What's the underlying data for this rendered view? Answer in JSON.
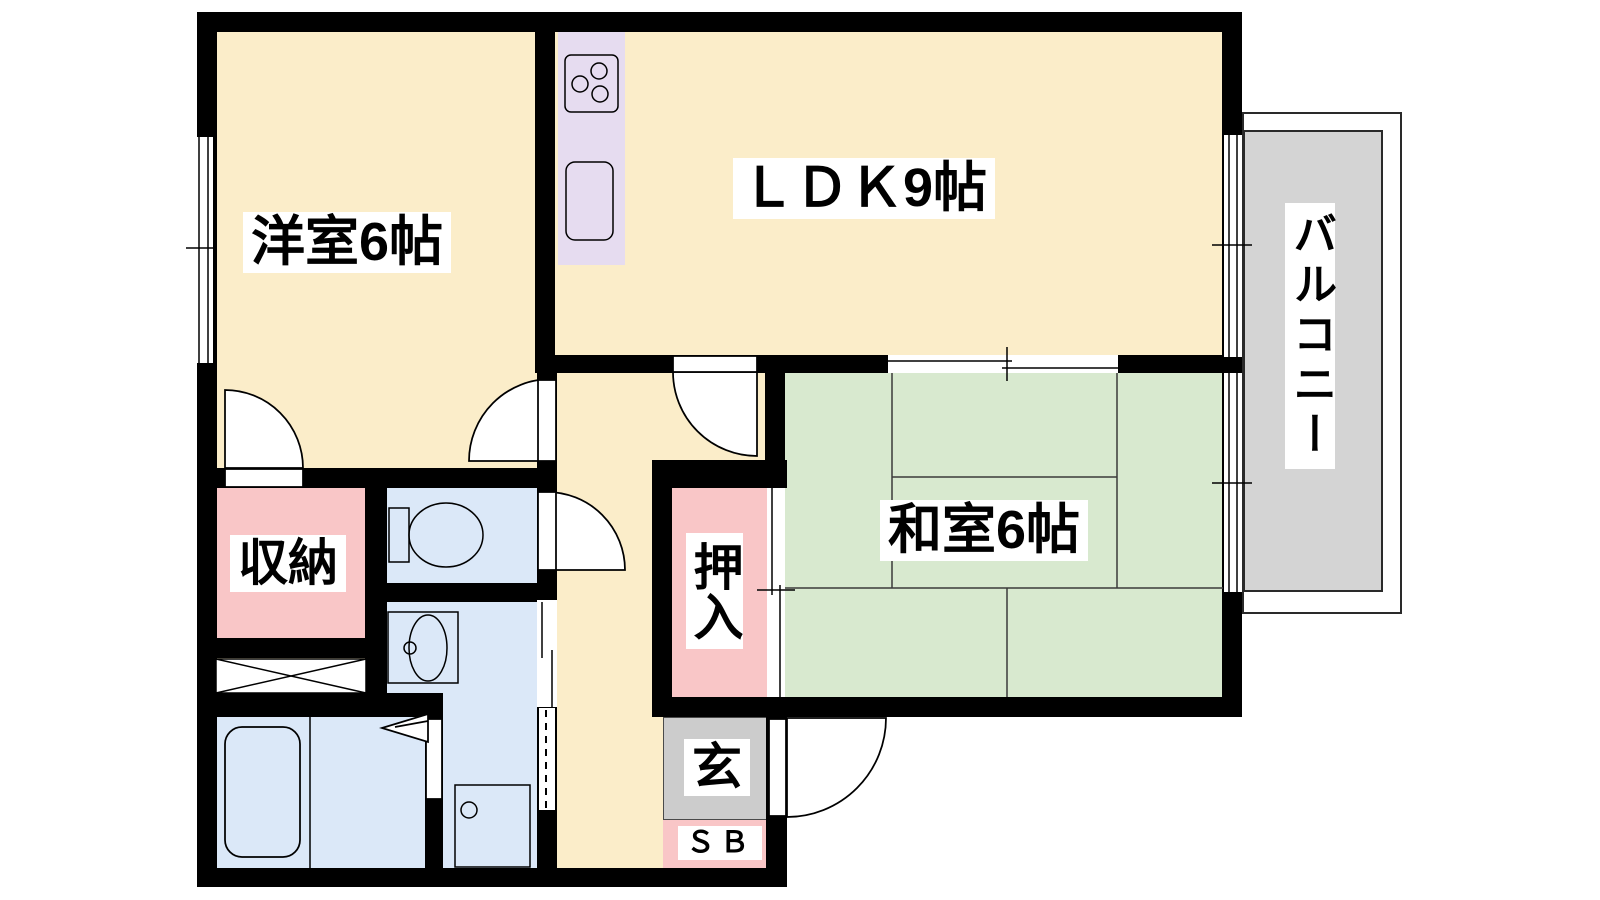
{
  "plan": {
    "type": "apartment-floor-plan",
    "labels": {
      "western_room": "洋室6帖",
      "ldk": "ＬＤＫ9帖",
      "japanese_room": "和室6帖",
      "balcony": "バルコニー",
      "storage": "収納",
      "closet": "押入",
      "entrance": "玄",
      "shoe_box": "ＳＢ"
    },
    "colors": {
      "wall": "#000000",
      "floor_cream": "#fbedc9",
      "tatami_green": "#d8e9cf",
      "wet_area_blue": "#dbe8f8",
      "closet_pink": "#f9c6c7",
      "kitchen_lavender": "#e6dcf0",
      "entrance_gray": "#cccccc",
      "balcony_gray": "#d4d4d4"
    },
    "fixtures": {
      "items": [
        "stove-icon",
        "kitchen-sink-icon",
        "toilet-icon",
        "washbasin-icon",
        "bathtub-icon",
        "washing-machine-pan-icon",
        "storage-cross-icon",
        "folding-bath-door-icon",
        "entry-door-icon",
        "window-icon",
        "sliding-door-icon"
      ]
    }
  }
}
